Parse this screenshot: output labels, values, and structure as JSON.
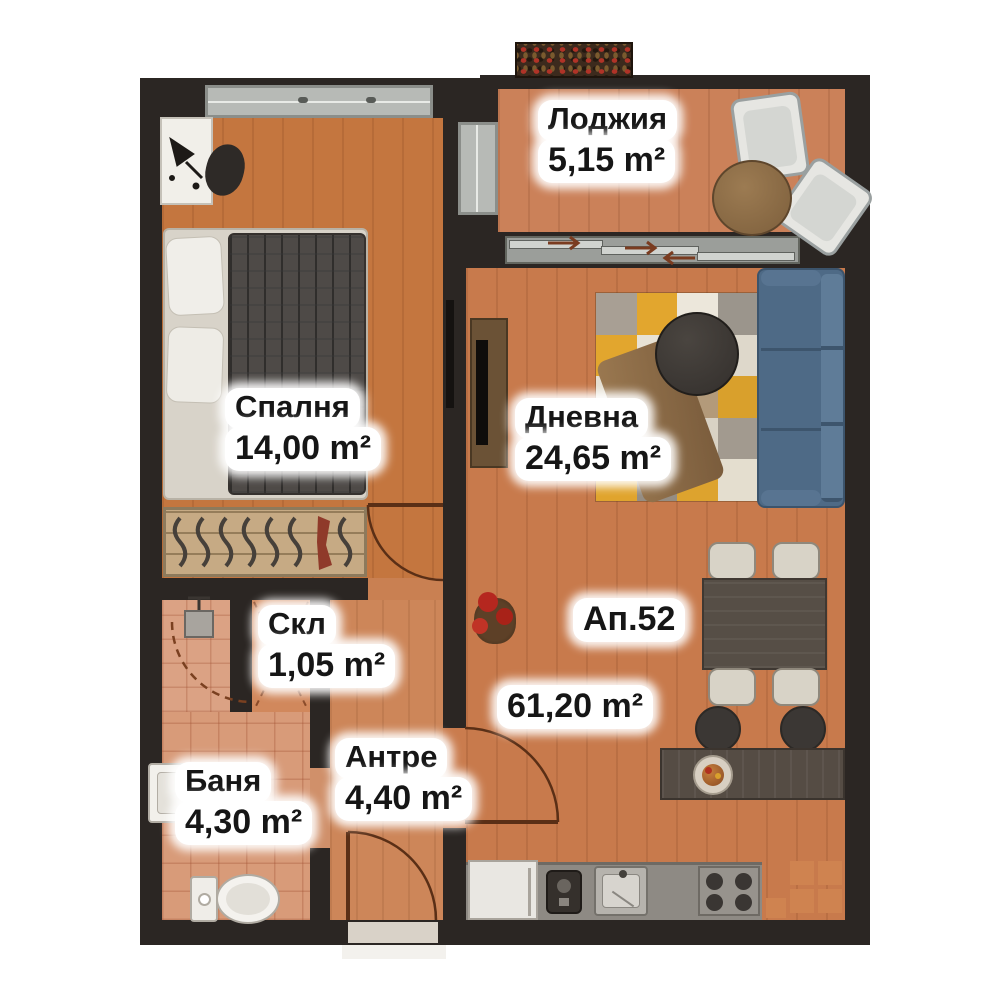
{
  "apartment": {
    "label": "Ап.52",
    "total_area": "61,20 m²"
  },
  "rooms": [
    {
      "key": "loggia",
      "name": "Лоджия",
      "area": "5,15 m²"
    },
    {
      "key": "bedroom",
      "name": "Спалня",
      "area": "14,00 m²"
    },
    {
      "key": "living",
      "name": "Дневна",
      "area": "24,65 m²"
    },
    {
      "key": "storage",
      "name": "Скл",
      "area": "1,05 m²"
    },
    {
      "key": "bathroom",
      "name": "Баня",
      "area": "4,30 m²"
    },
    {
      "key": "hall",
      "name": "Антре",
      "area": "4,40 m²"
    }
  ],
  "colors": {
    "wall": "#2b2623",
    "floor": "#c87a4c",
    "floor-light": "#d49a78",
    "window": "#b7bab6",
    "sofa": "#4e6a86",
    "rug-yellow": "#e2a62e",
    "wood": "#5a5148",
    "label-bg": "#ffffff",
    "label-text": "#161616"
  }
}
